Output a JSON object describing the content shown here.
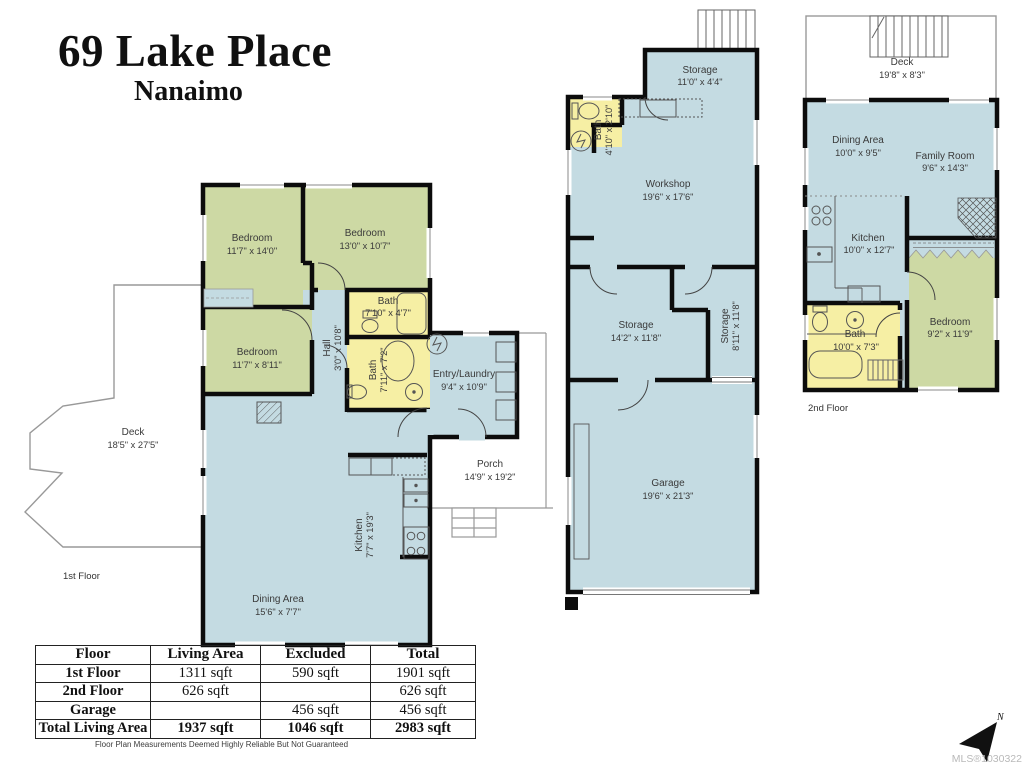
{
  "title": {
    "address": "69 Lake Place",
    "city": "Nanaimo"
  },
  "colors": {
    "living": "#c4dbe2",
    "bedroom": "#cdd9a4",
    "bath": "#f6efa4",
    "wall": "#0c0c0c",
    "deck_outline": "#999999",
    "label_text": "#3a3a3a",
    "mls_text": "#b9b9b9"
  },
  "floor1": {
    "label": "1st Floor",
    "deck": {
      "name": "Deck",
      "dims": "18'5\" x 27'5\""
    },
    "bedroom1": {
      "name": "Bedroom",
      "dims": "11'7\" x 14'0\""
    },
    "bedroom2": {
      "name": "Bedroom",
      "dims": "13'0\" x 10'7\""
    },
    "bedroom3": {
      "name": "Bedroom",
      "dims": "11'7\" x 8'11\""
    },
    "bath1": {
      "name": "Bath",
      "dims": "7'10\" x 4'7\""
    },
    "bath2": {
      "name": "Bath",
      "dims": "7'11\" x 7'2\""
    },
    "hall": {
      "name": "Hall",
      "dims": "3'0\" x 10'8\""
    },
    "entry": {
      "name": "Entry/Laundry",
      "dims": "9'4\" x 10'9\""
    },
    "porch": {
      "name": "Porch",
      "dims": "14'9\" x 19'2\""
    },
    "kitchen": {
      "name": "Kitchen",
      "dims": "7'7\" x 19'3\""
    },
    "dining": {
      "name": "Dining Area",
      "dims": "15'6\" x 7'7\""
    }
  },
  "garage_building": {
    "storage1": {
      "name": "Storage",
      "dims": "11'0\" x 4'4\""
    },
    "bath": {
      "name": "Bath",
      "dims": "4'10\" x 2'10\""
    },
    "workshop": {
      "name": "Workshop",
      "dims": "19'6\" x 17'6\""
    },
    "storage2": {
      "name": "Storage",
      "dims": "14'2\" x 11'8\""
    },
    "storage3": {
      "name": "Storage",
      "dims": "8'11\" x 11'8\""
    },
    "garage": {
      "name": "Garage",
      "dims": "19'6\" x 21'3\""
    }
  },
  "floor2": {
    "label": "2nd Floor",
    "deck": {
      "name": "Deck",
      "dims": "19'8\" x 8'3\""
    },
    "dining": {
      "name": "Dining Area",
      "dims": "10'0\" x 9'5\""
    },
    "family": {
      "name": "Family Room",
      "dims": "9'6\" x 14'3\""
    },
    "kitchen": {
      "name": "Kitchen",
      "dims": "10'0\" x 12'7\""
    },
    "bath": {
      "name": "Bath",
      "dims": "10'0\" x 7'3\""
    },
    "bedroom": {
      "name": "Bedroom",
      "dims": "9'2\" x 11'9\""
    }
  },
  "area_table": {
    "headers": [
      "Floor",
      "Living Area",
      "Excluded",
      "Total"
    ],
    "rows": [
      {
        "floor": "1st Floor",
        "living": "1311 sqft",
        "excluded": "590 sqft",
        "total": "1901 sqft"
      },
      {
        "floor": "2nd Floor",
        "living": "626 sqft",
        "excluded": "",
        "total": "626 sqft"
      },
      {
        "floor": "Garage",
        "living": "",
        "excluded": "456 sqft",
        "total": "456 sqft"
      },
      {
        "floor": "Total Living Area",
        "living": "1937 sqft",
        "excluded": "1046 sqft",
        "total": "2983 sqft"
      }
    ]
  },
  "disclaimer": "Floor Plan Measurements Deemed Highly Reliable But Not Guaranteed",
  "mls": "MLS®1030322",
  "compass": {
    "label": "N"
  }
}
